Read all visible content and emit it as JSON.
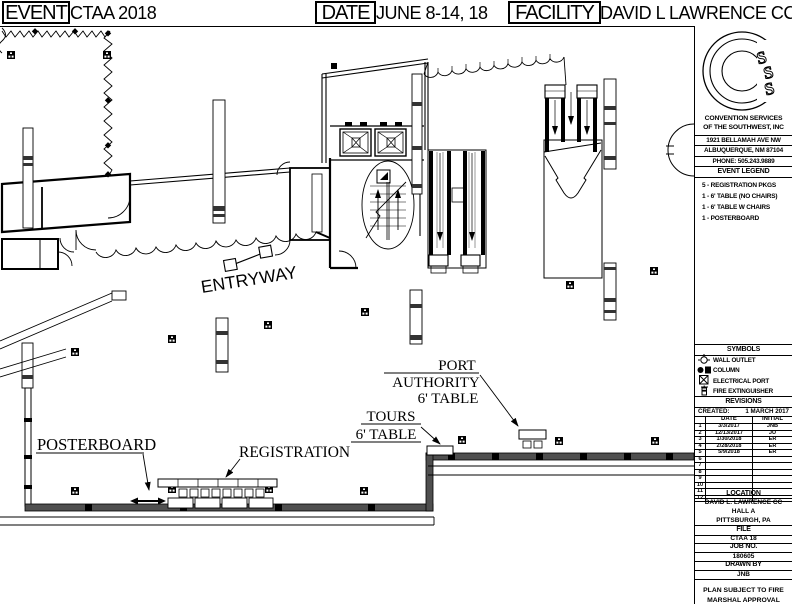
{
  "header": {
    "event_label": "EVENT",
    "event_value": "CTAA 2018",
    "date_label": "DATE",
    "date_value": "JUNE 8-14, 18",
    "facility_label": "FACILITY",
    "facility_value": "DAVID L LAWRENCE CC"
  },
  "sidebar": {
    "company": {
      "name_line1": "CONVENTION SERVICES",
      "name_line2": "OF THE SOUTHWEST, INC",
      "address_line1": "1921 BELLAMAH AVE NW",
      "address_line2": "ALBUQUERQUE, NM 87104",
      "phone": "PHONE: 505.243.9889"
    },
    "event_legend": {
      "title": "EVENT LEGEND",
      "items": [
        "5 - REGISTRATION PKGS",
        "1 - 6' TABLE (NO CHAIRS)",
        "1 - 6' TABLE W CHAIRS",
        "1 - POSTERBOARD"
      ]
    },
    "symbols": {
      "title": "SYMBOLS",
      "items": [
        {
          "icon": "wall-outlet-icon",
          "label": "WALL OUTLET"
        },
        {
          "icon": "column-icon",
          "label": "COLUMN"
        },
        {
          "icon": "electrical-port-icon",
          "label": "ELECTRICAL PORT"
        },
        {
          "icon": "fire-extinguisher-icon",
          "label": "FIRE EXTINGUISHER"
        }
      ]
    },
    "revisions": {
      "title": "REVISIONS",
      "created_label": "CREATED:",
      "created_value": "1 MARCH 2017",
      "col_date": "DATE",
      "col_initial": "INITIAL",
      "rows": [
        {
          "num": "1",
          "date": "3/3/2017",
          "initial": "JNB"
        },
        {
          "num": "2",
          "date": "12/13/2017",
          "initial": "JU"
        },
        {
          "num": "3",
          "date": "1/30/2018",
          "initial": "ER"
        },
        {
          "num": "4",
          "date": "2/28/2018",
          "initial": "ER"
        },
        {
          "num": "5",
          "date": "5/9/2018",
          "initial": "ER"
        },
        {
          "num": "6",
          "date": "",
          "initial": ""
        },
        {
          "num": "7",
          "date": "",
          "initial": ""
        },
        {
          "num": "8",
          "date": "",
          "initial": ""
        },
        {
          "num": "9",
          "date": "",
          "initial": ""
        },
        {
          "num": "10",
          "date": "",
          "initial": ""
        },
        {
          "num": "11",
          "date": "",
          "initial": ""
        },
        {
          "num": "12",
          "date": "",
          "initial": ""
        }
      ]
    },
    "location": {
      "title": "LOCATION",
      "line1": "DAVID L. LAWRENCE CC",
      "line2": "HALL A",
      "line3": "PITTSBURGH, PA"
    },
    "file": {
      "title": "FILE",
      "value": "CTAA 18"
    },
    "job": {
      "title": "JOB NO.",
      "value": "180605"
    },
    "drawn_by": {
      "title": "DRAWN BY",
      "value": "JNB"
    },
    "note_line1": "PLAN SUBJECT TO FIRE",
    "note_line2": "MARSHAL APPROVAL"
  },
  "plan_labels": {
    "entryway": "ENTRYWAY",
    "posterboard": "POSTERBOARD",
    "registration": "REGISTRATION",
    "tours_line1": "TOURS",
    "tours_line2": "6' TABLE",
    "port_authority_line1": "PORT",
    "port_authority_line2": "AUTHORITY",
    "port_authority_line3": "6' TABLE"
  },
  "colors": {
    "ink": "#000000",
    "paper": "#ffffff",
    "wall_gray": "#4f4f4f"
  }
}
